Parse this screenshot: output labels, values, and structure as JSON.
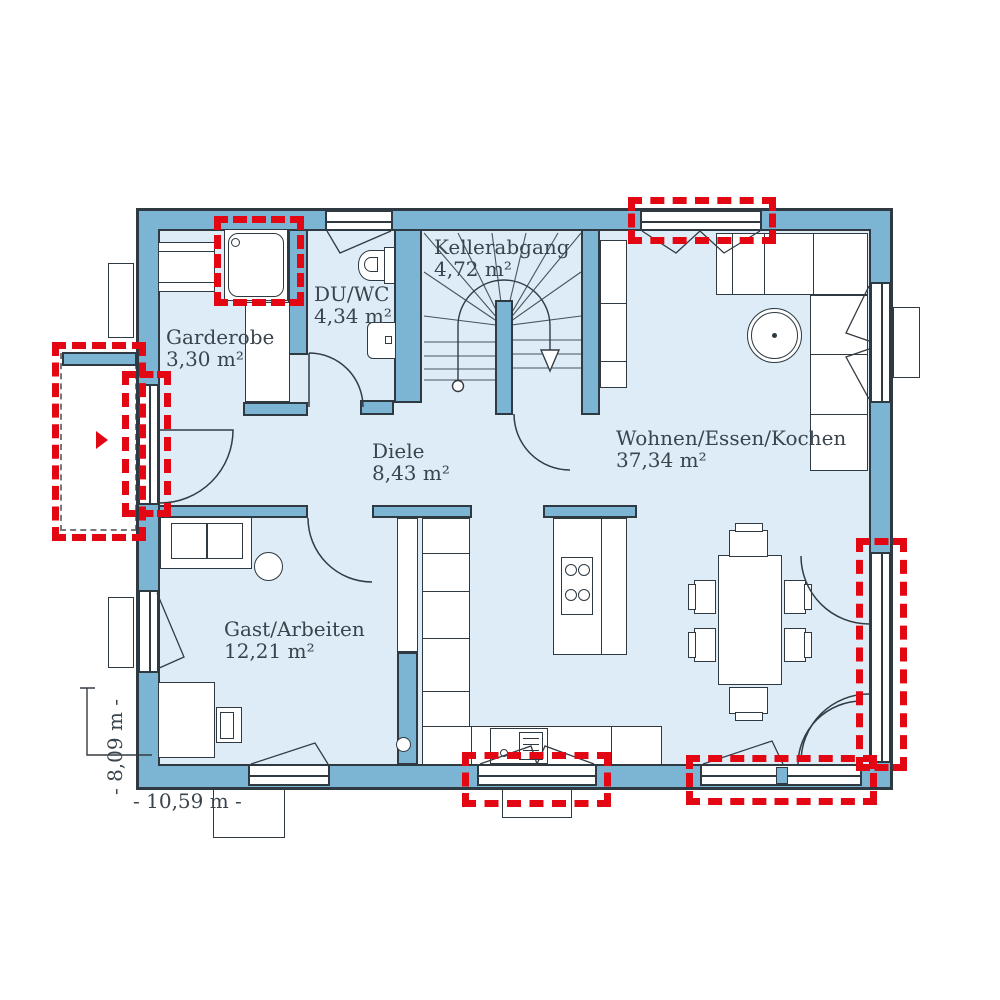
{
  "colors": {
    "wall": "#7cb5d4",
    "floor": "#ddecf6",
    "outline": "#2e3941",
    "accent_red": "#e30613",
    "text": "#3a444d",
    "background": "#ffffff"
  },
  "rooms": [
    {
      "id": "garderobe",
      "name": "Garderobe",
      "area": "3,30 m²"
    },
    {
      "id": "duwc",
      "name": "DU/WC",
      "area": "4,34 m²"
    },
    {
      "id": "kellerabgang",
      "name": "Kellerabgang",
      "area": "4,72 m²"
    },
    {
      "id": "diele",
      "name": "Diele",
      "area": "8,43 m²"
    },
    {
      "id": "wohnen",
      "name": "Wohnen/Essen/Kochen",
      "area": "37,34 m²"
    },
    {
      "id": "gast",
      "name": "Gast/Arbeiten",
      "area": "12,21 m²"
    }
  ],
  "dimensions": {
    "width_label": "- 10,59 m -",
    "height_label": "- 8,09 m -"
  },
  "icons": {
    "entrance_arrow": "triangle-right-red",
    "stair_arrow": "arrow-down"
  },
  "highlights": {
    "count": 7,
    "meaning": "optional-window-door-markers"
  }
}
